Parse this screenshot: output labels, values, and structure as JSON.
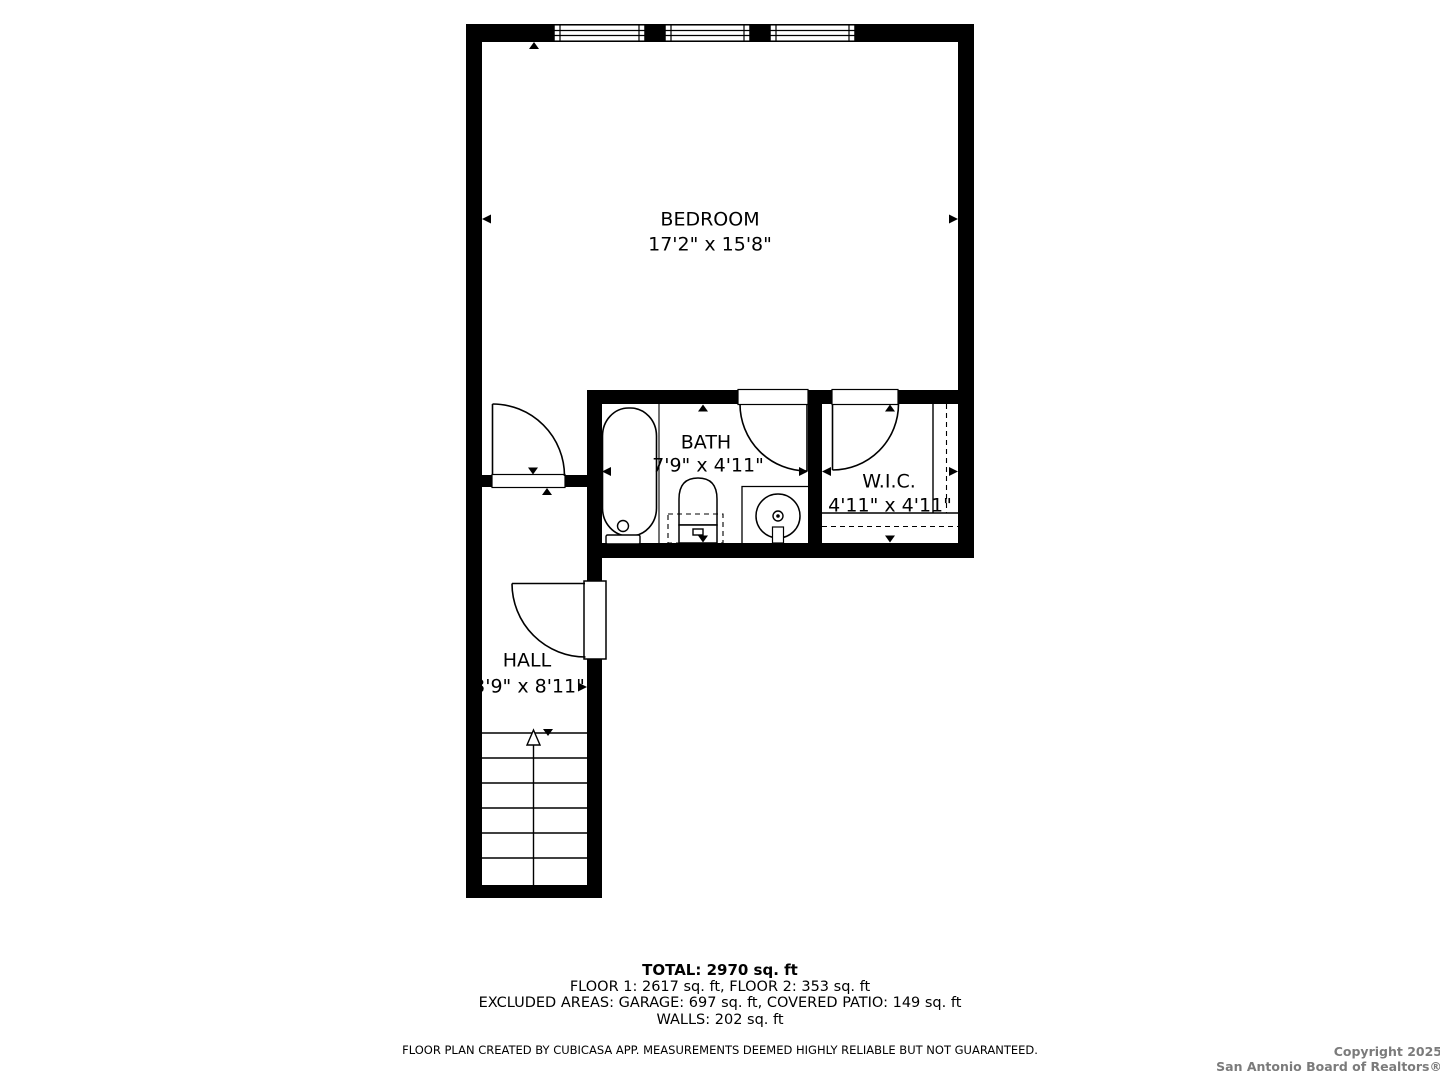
{
  "rooms": [
    {
      "name": "BEDROOM",
      "dims": "17'2\" x 15'8\""
    },
    {
      "name": "BATH",
      "dims": "7'9\" x 4'11\""
    },
    {
      "name": "W.I.C.",
      "dims": "4'11\" x 4'11\""
    },
    {
      "name": "HALL",
      "dims": "3'9\" x 8'11\""
    }
  ],
  "summary": {
    "total": "TOTAL: 2970 sq. ft",
    "floors": "FLOOR 1: 2617 sq. ft, FLOOR 2: 353 sq. ft",
    "excluded": "EXCLUDED AREAS: GARAGE: 697 sq. ft, COVERED PATIO: 149 sq. ft",
    "walls": "WALLS: 202 sq. ft"
  },
  "disclaimer": "FLOOR PLAN CREATED BY CUBICASA APP. MEASUREMENTS DEEMED HIGHLY RELIABLE BUT NOT GUARANTEED.",
  "copyright": {
    "line1": "Copyright 2025",
    "line2": "San Antonio Board of Realtors®"
  },
  "colors": {
    "wall": "#000000",
    "background": "#ffffff",
    "copyright_text": "#7b7b7b"
  }
}
